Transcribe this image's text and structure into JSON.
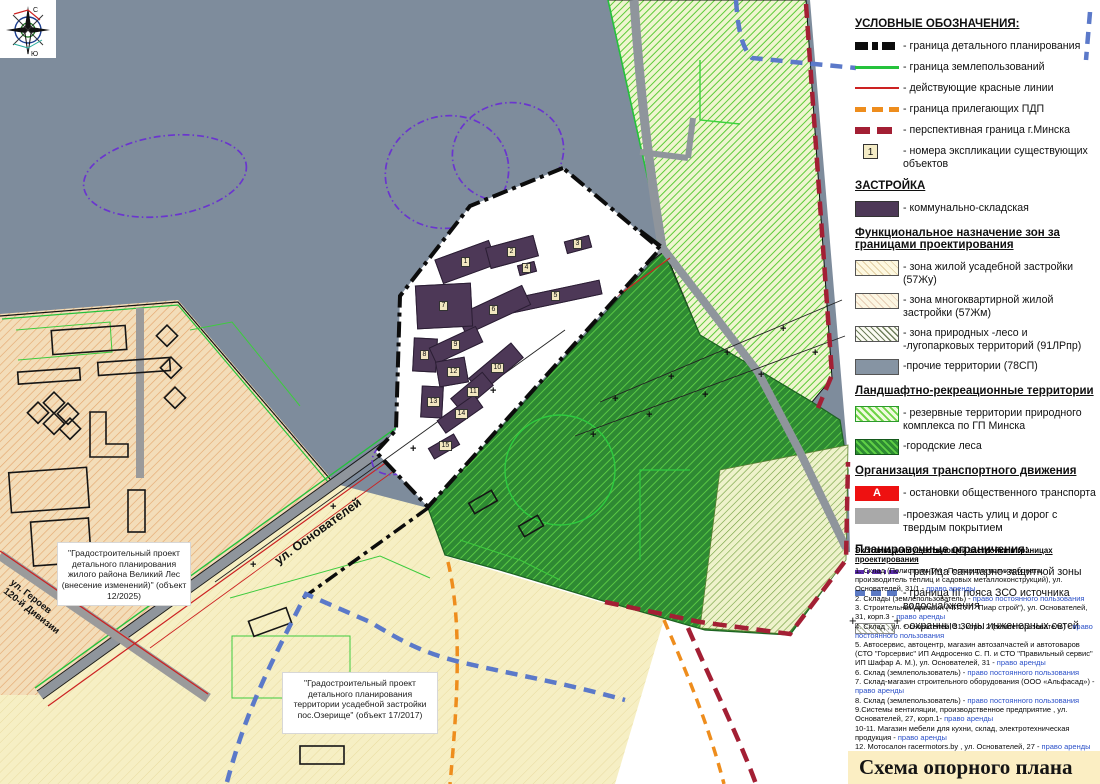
{
  "title_block": {
    "text": "Схема опорного плана"
  },
  "compass": {
    "north_label": "С",
    "south_label": "Ю"
  },
  "colors": {
    "other_territories": "#7e8c9c",
    "communal_storage": "#4d3857",
    "urban_forest_green": "#2e8b33",
    "reserve_hatch_green": "#5ecb39",
    "bus_stop_red": "#ee1111",
    "minsk_boundary_crimson": "#a31f34",
    "pdp_boundary_orange": "#ee8d1d",
    "red_lines": "#cc2222",
    "land_use_green": "#25c23c",
    "sanitary_zone_purple": "#6a35cf",
    "zso_blue": "#5b79c9",
    "tenure_text_blue": "#2b50c8",
    "title_bg": "#fbeec3"
  },
  "map": {
    "street_labels": {
      "osnovateley": "ул. Основателей",
      "geroev_line1": "ул. Героев",
      "geroev_line2": "120-й Дивизии"
    },
    "note_boxes": {
      "box1": "\"Градостроительный проект детального планирования жилого района Великий Лес (внесение изменений)\" (объект 12/2025)",
      "box2": "\"Градостроительный проект детального планирования территории усадебной застройки пос.Озерище\" (объект 17/2017)"
    },
    "buildings": [
      {
        "label": "1",
        "x": 466,
        "y": 262,
        "w": 58,
        "h": 26,
        "rot": -20
      },
      {
        "label": "2",
        "x": 512,
        "y": 252,
        "w": 50,
        "h": 22,
        "rot": -15
      },
      {
        "label": "3",
        "x": 578,
        "y": 244,
        "w": 26,
        "h": 13,
        "rot": -15
      },
      {
        "label": "4",
        "x": 527,
        "y": 268,
        "w": 18,
        "h": 11,
        "rot": -15
      },
      {
        "label": "5",
        "x": 556,
        "y": 296,
        "w": 92,
        "h": 15,
        "rot": -12
      },
      {
        "label": "6",
        "x": 494,
        "y": 310,
        "w": 72,
        "h": 22,
        "rot": -25
      },
      {
        "label": "7",
        "x": 444,
        "y": 306,
        "w": 56,
        "h": 44,
        "rot": -3
      },
      {
        "label": "8",
        "x": 425,
        "y": 355,
        "w": 24,
        "h": 34,
        "rot": 3
      },
      {
        "label": "9",
        "x": 456,
        "y": 345,
        "w": 52,
        "h": 18,
        "rot": -25
      },
      {
        "label": "10",
        "x": 496,
        "y": 368,
        "w": 56,
        "h": 20,
        "rot": -40
      },
      {
        "label": "11",
        "x": 472,
        "y": 392,
        "w": 42,
        "h": 18,
        "rot": -40
      },
      {
        "label": "12",
        "x": 452,
        "y": 372,
        "w": 30,
        "h": 26,
        "rot": -10
      },
      {
        "label": "13",
        "x": 432,
        "y": 402,
        "w": 22,
        "h": 32,
        "rot": 3
      },
      {
        "label": "14",
        "x": 460,
        "y": 414,
        "w": 46,
        "h": 16,
        "rot": -35
      },
      {
        "label": "15",
        "x": 444,
        "y": 446,
        "w": 30,
        "h": 13,
        "rot": -30
      }
    ]
  },
  "legend": {
    "sections": [
      {
        "title": "УСЛОВНЫЕ ОБОЗНАЧЕНИЯ:",
        "items": [
          {
            "swatch": "line-black-dash",
            "label": "- граница детального планирования"
          },
          {
            "swatch": "line-green",
            "label": "- граница землепользований"
          },
          {
            "swatch": "line-red",
            "label": "- действующие красные линии"
          },
          {
            "swatch": "line-orange-dash",
            "label": "- граница прилегающих ПДП"
          },
          {
            "swatch": "line-crimson-dash",
            "label": "- перспективная граница г.Минска"
          },
          {
            "swatch": "numbox",
            "swatch_text": "1",
            "label": "- номера экспликации существующих объектов"
          }
        ]
      },
      {
        "title": "ЗАСТРОЙКА",
        "items": [
          {
            "swatch": "fill-purple",
            "label": "- коммунально-складская"
          }
        ]
      },
      {
        "title": "Функциональное назначение зон за границами проектирования",
        "items": [
          {
            "swatch": "fill-cream-hatch",
            "label": "- зона жилой усадебной застройки (57Жу)"
          },
          {
            "swatch": "fill-cream-hatch2",
            "label": "- зона многоквартирной жилой застройки (57Жм)"
          },
          {
            "swatch": "fill-zone-hatch",
            "label": "- зона природных -лесо и -лугопарковых территорий (91ЛРпр)"
          },
          {
            "swatch": "fill-gray",
            "label": "-прочие территории (78СП)"
          }
        ]
      },
      {
        "title": "Ландшафтно-рекреационные территории",
        "items": [
          {
            "swatch": "fill-lightgreen-hatch",
            "label": "- резервные территории природного комплекса по ГП Минска"
          },
          {
            "swatch": "fill-green-hatch",
            "label": "-городские леса"
          }
        ]
      },
      {
        "title": "Организация транспортного движения",
        "items": [
          {
            "swatch": "busstop",
            "swatch_text": "А",
            "label": "- остановки общественного транспорта"
          },
          {
            "swatch": "fill-roadgray",
            "label": "-проезжая часть улиц и дорог с твердым покрытием"
          }
        ]
      },
      {
        "title": "Планировочные ограничения:",
        "items": [
          {
            "swatch": "line-purple-dashdot",
            "label": "- граница  санитарно-защитной зоны"
          },
          {
            "swatch": "line-blue-dash",
            "label": "- граница III пояса ЗСО источника водоснабжения"
          },
          {
            "swatch": "ohr-zone",
            "label": "- охранные зоны инженерных сетей"
          }
        ]
      }
    ]
  },
  "explication": {
    "header": "Экспликация существующей застройки в границах проектирования",
    "items": [
      {
        "text": "1. Склад (Полистрим ТМ - Поставщик поликарбоната, производитель теплиц и садовых металлоконструкций), ул. Основателей, 31/1 - ",
        "tenure": "право аренды"
      },
      {
        "text": "2. Склады (землепользователь) - ",
        "tenure": "право постоянного пользования"
      },
      {
        "text": "3. Строительный магазин (ЧПТУП \"Пиар строй\"), ул. Основателей, 31, корп.3 - ",
        "tenure": "право аренды"
      },
      {
        "text": "4. Склад , ул. Основателей, 31, корп. 2 (землепользователь) - ",
        "tenure": "право постоянного пользования"
      },
      {
        "text": "5. Автосервис, автоцентр, магазин автозапчастей и автотоваров (СТО \"Горсервис\" ИП Андросенко С. П. и СТО \"Правильный сервис\" ИП Шафар  А. М.), ул. Основателей, 31 - ",
        "tenure": "право аренды"
      },
      {
        "text": "6. Склад (землепользователь) - ",
        "tenure": "право постоянного пользования"
      },
      {
        "text": "7. Склад-магазин строительного оборудования (ООО «Альфасад») - ",
        "tenure": "право аренды"
      },
      {
        "text": "8. Склад (землепользователь) - ",
        "tenure": "право постоянного пользования"
      },
      {
        "text": "9.Системы вентиляции, производственное предприятие , ул. Основателей, 27, корп.1- ",
        "tenure": "право аренды"
      },
      {
        "text": "10-11. Магазин мебели для кухни, склад, электротехническая продукция  - ",
        "tenure": "право аренды"
      },
      {
        "text": "12. Мотосалон racermotors.by , ул. Основателей, 27 - ",
        "tenure": "право аренды"
      },
      {
        "text": "13. СТО Автосервис Ромашка (ООО \"СТОБОНУС\"), ул. Основателей,17/1 - ",
        "tenure": "право аренды"
      },
      {
        "text": "14.Склад (землепользователь) - ",
        "tenure": "право постоянного пользования"
      },
      {
        "text": "15. Склад (ООО Агрощит \"Прицепцентр.бел\"), ул. Основателей, 17/2 - ",
        "tenure": "право аренды"
      }
    ]
  }
}
